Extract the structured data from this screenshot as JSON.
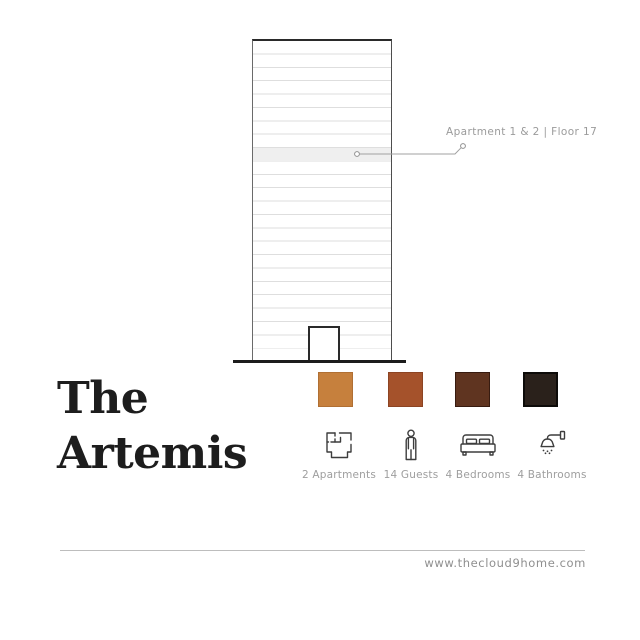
{
  "title": {
    "line1": "The",
    "line2": "Artemis"
  },
  "building": {
    "callout_label": "Apartment 1 & 2 | Floor 17"
  },
  "palette": [
    {
      "name": "camel-orange",
      "color": "#c6803d",
      "border": "#b06f33"
    },
    {
      "name": "rust-brown",
      "color": "#a5522b",
      "border": "#8c4423"
    },
    {
      "name": "dark-brown",
      "color": "#5f3420",
      "border": "#371b10"
    },
    {
      "name": "near-black",
      "color": "#2a211b",
      "border": "#0d0b09"
    }
  ],
  "stats": [
    {
      "icon": "floorplan-icon",
      "label": "2 Apartments"
    },
    {
      "icon": "person-icon",
      "label": "14 Guests"
    },
    {
      "icon": "bed-icon",
      "label": "4 Bedrooms"
    },
    {
      "icon": "shower-icon",
      "label": "4 Bathrooms"
    }
  ],
  "footer": {
    "website": "www.thecloud9home.com"
  }
}
